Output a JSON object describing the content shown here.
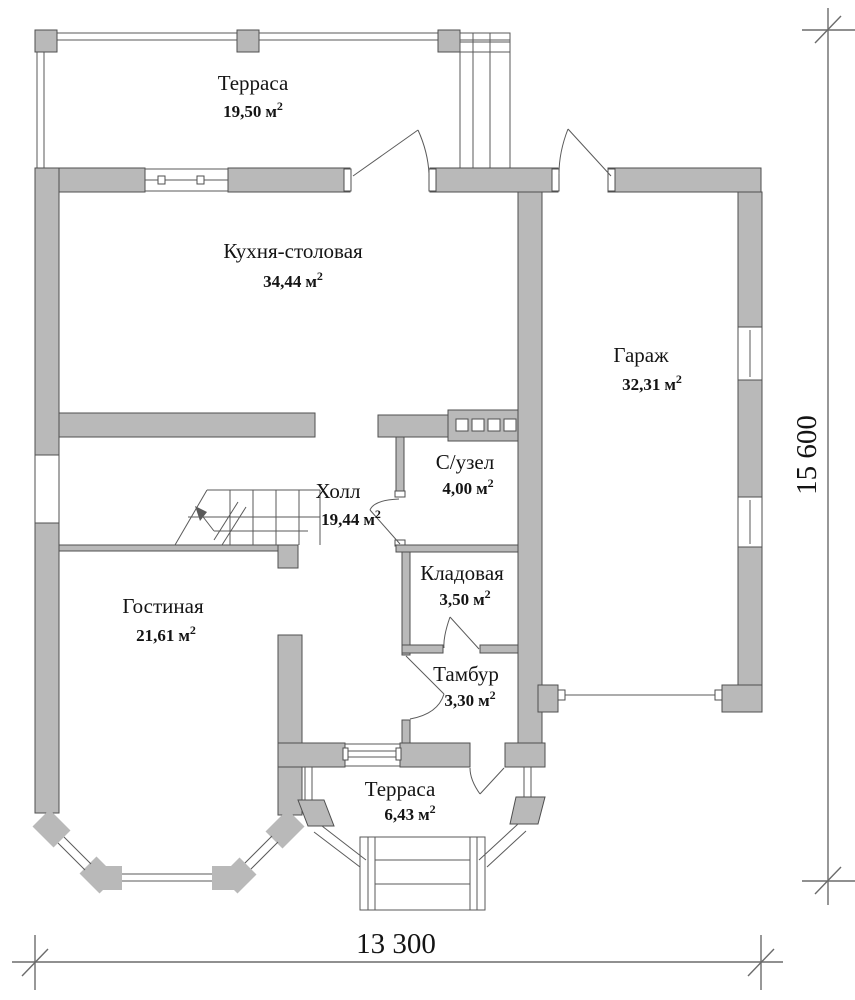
{
  "plan_title": "First floor plan",
  "colors": {
    "wall_fill": "#b9b9b9",
    "outline": "#4f4f4f",
    "thin_line": "#5a5a5a",
    "text": "#141414",
    "background": "#ffffff"
  },
  "units": {
    "area_unit": "м",
    "area_sup": "2"
  },
  "rooms": [
    {
      "name": "Терраса",
      "area": "19,50"
    },
    {
      "name": "Кухня-столовая",
      "area": "34,44"
    },
    {
      "name": "Гараж",
      "area": "32,31"
    },
    {
      "name": "Холл",
      "area": "19,44"
    },
    {
      "name": "С/узел",
      "area": "4,00"
    },
    {
      "name": "Кладовая",
      "area": "3,50"
    },
    {
      "name": "Гостиная",
      "area": "21,61"
    },
    {
      "name": "Тамбур",
      "area": "3,30"
    },
    {
      "name": "Терраса",
      "area": "6,43"
    }
  ],
  "dimensions": {
    "width_label": "13 300",
    "height_label": "15 600"
  }
}
